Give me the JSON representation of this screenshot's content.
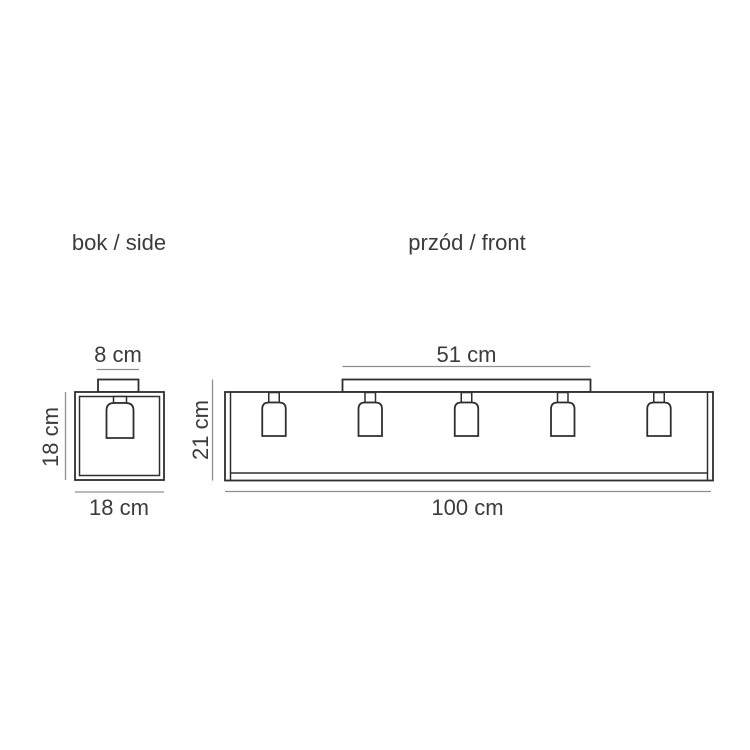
{
  "diagram": {
    "colors": {
      "background": "#ffffff",
      "line": "#2e2e2e",
      "dimension_line": "#8f8f8f",
      "text": "#3b3b3b"
    },
    "side_view": {
      "label": "bok / side",
      "canopy_width": "8 cm",
      "height": "18 cm",
      "width": "18 cm"
    },
    "front_view": {
      "label": "przód / front",
      "canopy_width": "51 cm",
      "height": "21 cm",
      "width": "100 cm",
      "shade_count": 5
    }
  }
}
